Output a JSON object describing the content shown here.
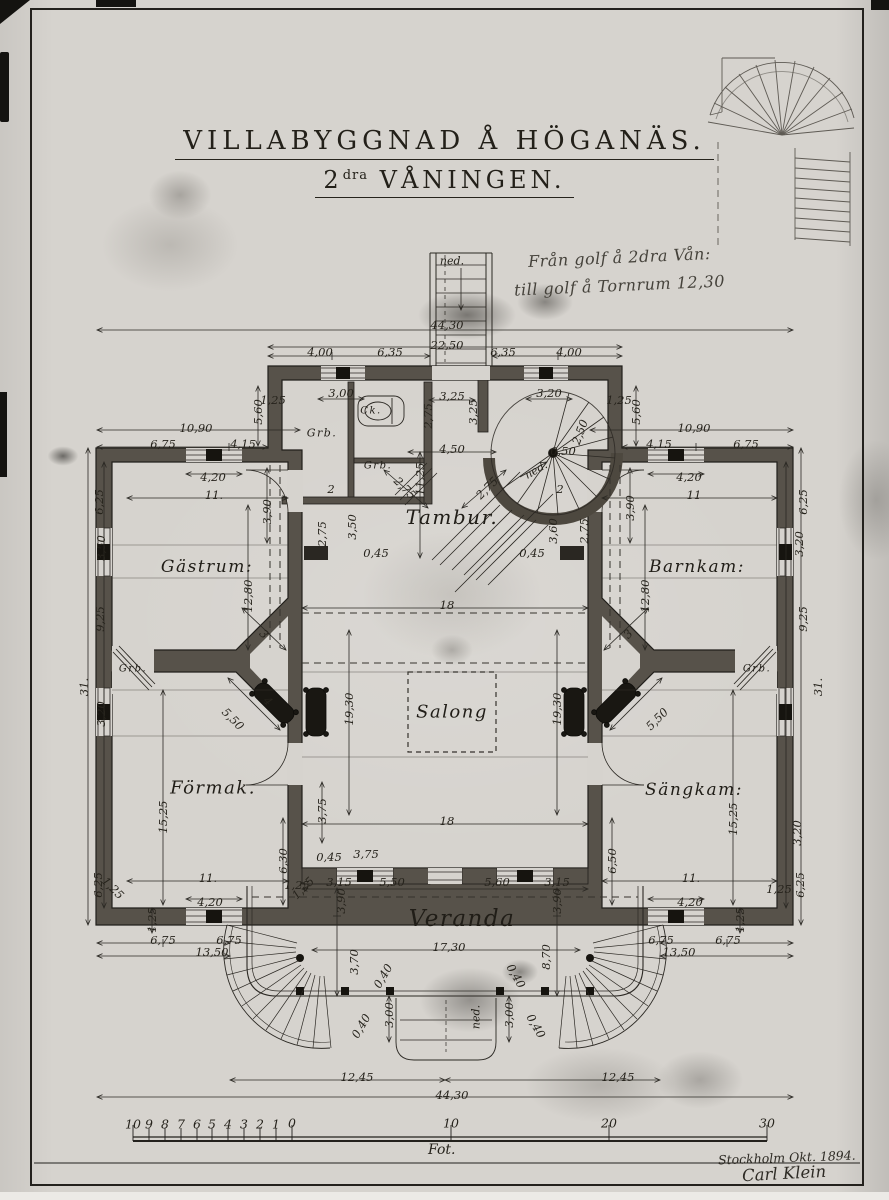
{
  "title": {
    "line1": "VILLABYGGNAD Å HÖGANÄS.",
    "line2_num": "2",
    "line2_sup": "dra",
    "line2_rest": " VÅNINGEN."
  },
  "note": {
    "line1": "Från golf å 2dra Vån:",
    "line2": "till golf å Tornrum 12,30"
  },
  "signature": {
    "line1": "Stockholm Okt. 1894.",
    "line2": "Carl Klein"
  },
  "scale": {
    "unit": "Fot.",
    "numbers": [
      {
        "t": "10",
        "x": 133,
        "y": 1124
      },
      {
        "t": "9",
        "x": 149,
        "y": 1124
      },
      {
        "t": "8",
        "x": 165,
        "y": 1124
      },
      {
        "t": "7",
        "x": 181,
        "y": 1124
      },
      {
        "t": "6",
        "x": 197,
        "y": 1124
      },
      {
        "t": "5",
        "x": 212,
        "y": 1124
      },
      {
        "t": "4",
        "x": 228,
        "y": 1124
      },
      {
        "t": "3",
        "x": 244,
        "y": 1124
      },
      {
        "t": "2",
        "x": 260,
        "y": 1124
      },
      {
        "t": "1",
        "x": 276,
        "y": 1124
      },
      {
        "t": "0",
        "x": 292,
        "y": 1123
      },
      {
        "t": "10",
        "x": 451,
        "y": 1123
      },
      {
        "t": "20",
        "x": 609,
        "y": 1123
      },
      {
        "t": "30",
        "x": 767,
        "y": 1123
      }
    ]
  },
  "plan": {
    "rooms": [
      {
        "t": "Tambur.",
        "x": 452,
        "y": 517,
        "s": 20
      },
      {
        "t": "Gästrum:",
        "x": 207,
        "y": 567,
        "s": 17
      },
      {
        "t": "Barnkam:",
        "x": 697,
        "y": 567,
        "s": 17
      },
      {
        "t": "Salong",
        "x": 452,
        "y": 712,
        "s": 18
      },
      {
        "t": "Förmak.",
        "x": 213,
        "y": 788,
        "s": 18
      },
      {
        "t": "Sängkam:",
        "x": 694,
        "y": 790,
        "s": 17
      },
      {
        "t": "Veranda",
        "x": 462,
        "y": 919,
        "s": 23
      },
      {
        "t": "Grb.",
        "x": 322,
        "y": 433,
        "s": 11
      },
      {
        "t": "Ck.",
        "x": 371,
        "y": 411,
        "s": 10
      },
      {
        "t": "Grb.",
        "x": 378,
        "y": 466,
        "s": 10
      },
      {
        "t": "Grb.",
        "x": 133,
        "y": 669,
        "s": 10
      },
      {
        "t": "Grb.",
        "x": 757,
        "y": 669,
        "s": 10
      }
    ],
    "annotations": [
      {
        "t": "ned.",
        "x": 452,
        "y": 261
      },
      {
        "t": "ned.",
        "x": 536,
        "y": 470,
        "r": -30
      },
      {
        "t": "ned.",
        "x": 476,
        "y": 1017,
        "r": -90
      }
    ],
    "dims": [
      {
        "t": "44,30",
        "x": 447,
        "y": 325
      },
      {
        "t": "22,50",
        "x": 447,
        "y": 345
      },
      {
        "t": "4,00",
        "x": 320,
        "y": 352
      },
      {
        "t": "6,35",
        "x": 390,
        "y": 352
      },
      {
        "t": "6,35",
        "x": 503,
        "y": 352
      },
      {
        "t": "4,00",
        "x": 569,
        "y": 352
      },
      {
        "t": "3,00",
        "x": 341,
        "y": 393
      },
      {
        "t": "3,25",
        "x": 452,
        "y": 396
      },
      {
        "t": "3,20",
        "x": 549,
        "y": 393
      },
      {
        "t": "1,25",
        "x": 619,
        "y": 400
      },
      {
        "t": "1,25",
        "x": 273,
        "y": 400
      },
      {
        "t": "5,60",
        "x": 636,
        "y": 412,
        "r": -90
      },
      {
        "t": "5,60",
        "x": 258,
        "y": 412,
        "r": -90
      },
      {
        "t": "10,90",
        "x": 196,
        "y": 428
      },
      {
        "t": "10,90",
        "x": 694,
        "y": 428
      },
      {
        "t": "6,75",
        "x": 163,
        "y": 444
      },
      {
        "t": "4,15",
        "x": 243,
        "y": 444
      },
      {
        "t": "4,15",
        "x": 659,
        "y": 444
      },
      {
        "t": "6,75",
        "x": 746,
        "y": 444
      },
      {
        "t": "4,20",
        "x": 213,
        "y": 477
      },
      {
        "t": "4,20",
        "x": 689,
        "y": 477
      },
      {
        "t": "11.",
        "x": 214,
        "y": 495
      },
      {
        "t": "11",
        "x": 694,
        "y": 495
      },
      {
        "t": "3,90",
        "x": 267,
        "y": 512,
        "r": -90
      },
      {
        "t": "3,90",
        "x": 630,
        "y": 508,
        "r": -90
      },
      {
        "t": "2,75",
        "x": 428,
        "y": 416,
        "r": -90
      },
      {
        "t": "4,50",
        "x": 452,
        "y": 449
      },
      {
        "t": "11,25",
        "x": 420,
        "y": 479,
        "r": -90
      },
      {
        "t": "0,50",
        "x": 563,
        "y": 451
      },
      {
        "t": "2,50",
        "x": 580,
        "y": 432,
        "r": -70
      },
      {
        "t": "2,75",
        "x": 405,
        "y": 488,
        "r": 45
      },
      {
        "t": "2,75",
        "x": 487,
        "y": 488,
        "r": -45
      },
      {
        "t": "2",
        "x": 331,
        "y": 489
      },
      {
        "t": "2",
        "x": 560,
        "y": 489
      },
      {
        "t": "3,60",
        "x": 553,
        "y": 531,
        "r": -90
      },
      {
        "t": "2,75",
        "x": 584,
        "y": 531,
        "r": -90
      },
      {
        "t": "0,45",
        "x": 376,
        "y": 553
      },
      {
        "t": "0,45",
        "x": 532,
        "y": 553
      },
      {
        "t": "3,50",
        "x": 352,
        "y": 527,
        "r": -90
      },
      {
        "t": "2,75",
        "x": 322,
        "y": 534,
        "r": -90
      },
      {
        "t": "3,25",
        "x": 473,
        "y": 412,
        "r": -90
      },
      {
        "t": "6,25",
        "x": 99,
        "y": 502,
        "r": -90
      },
      {
        "t": "6,25",
        "x": 803,
        "y": 502,
        "r": -90
      },
      {
        "t": "3,50",
        "x": 101,
        "y": 548,
        "r": -90
      },
      {
        "t": "3,20",
        "x": 799,
        "y": 544,
        "r": -90
      },
      {
        "t": "9,25",
        "x": 100,
        "y": 619,
        "r": -90
      },
      {
        "t": "9,25",
        "x": 803,
        "y": 619,
        "r": -90
      },
      {
        "t": "31.",
        "x": 84,
        "y": 687,
        "r": -90
      },
      {
        "t": "31.",
        "x": 818,
        "y": 687,
        "r": -90
      },
      {
        "t": "3,20",
        "x": 101,
        "y": 714,
        "r": -90
      },
      {
        "t": "12,80",
        "x": 248,
        "y": 596,
        "r": -90
      },
      {
        "t": "12,80",
        "x": 645,
        "y": 596,
        "r": -90
      },
      {
        "t": "18",
        "x": 447,
        "y": 605
      },
      {
        "t": "18",
        "x": 447,
        "y": 821
      },
      {
        "t": "19,30",
        "x": 349,
        "y": 709,
        "r": -90
      },
      {
        "t": "19,30",
        "x": 557,
        "y": 709,
        "r": -90
      },
      {
        "t": "3",
        "x": 264,
        "y": 634,
        "r": 45
      },
      {
        "t": "3",
        "x": 628,
        "y": 634,
        "r": -45
      },
      {
        "t": "4",
        "x": 268,
        "y": 701,
        "r": 45
      },
      {
        "t": "5,50",
        "x": 233,
        "y": 719,
        "r": 45
      },
      {
        "t": "5,50",
        "x": 657,
        "y": 719,
        "r": -45
      },
      {
        "t": "15,25",
        "x": 163,
        "y": 817,
        "r": -90
      },
      {
        "t": "15,25",
        "x": 733,
        "y": 819,
        "r": -90
      },
      {
        "t": "6,30",
        "x": 283,
        "y": 861,
        "r": -90
      },
      {
        "t": "6,50",
        "x": 612,
        "y": 861,
        "r": -90
      },
      {
        "t": "3,75",
        "x": 322,
        "y": 811,
        "r": -90
      },
      {
        "t": "3,75",
        "x": 366,
        "y": 854
      },
      {
        "t": "0,45",
        "x": 329,
        "y": 857
      },
      {
        "t": "3,15",
        "x": 339,
        "y": 882
      },
      {
        "t": "5,50",
        "x": 392,
        "y": 882
      },
      {
        "t": "5,60",
        "x": 497,
        "y": 882
      },
      {
        "t": "3,15",
        "x": 557,
        "y": 882
      },
      {
        "t": "3,90",
        "x": 341,
        "y": 901,
        "r": -90
      },
      {
        "t": "3,90",
        "x": 557,
        "y": 901,
        "r": -90
      },
      {
        "t": "1,25",
        "x": 297,
        "y": 885
      },
      {
        "t": "11.",
        "x": 208,
        "y": 878
      },
      {
        "t": "11.",
        "x": 691,
        "y": 878
      },
      {
        "t": "4,20",
        "x": 210,
        "y": 902
      },
      {
        "t": "4,20",
        "x": 690,
        "y": 902
      },
      {
        "t": "3,20",
        "x": 797,
        "y": 833,
        "r": -90
      },
      {
        "t": "6,25",
        "x": 800,
        "y": 885,
        "r": -90
      },
      {
        "t": "6,25",
        "x": 98,
        "y": 885,
        "r": -90
      },
      {
        "t": "1,25",
        "x": 779,
        "y": 889
      },
      {
        "t": "17,30",
        "x": 449,
        "y": 947
      },
      {
        "t": "3,70",
        "x": 354,
        "y": 962,
        "r": -90
      },
      {
        "t": "8,70",
        "x": 546,
        "y": 957,
        "r": -90
      },
      {
        "t": "0,40",
        "x": 383,
        "y": 976,
        "r": -60
      },
      {
        "t": "0,40",
        "x": 516,
        "y": 976,
        "r": 60
      },
      {
        "t": "0,40",
        "x": 361,
        "y": 1026,
        "r": -60
      },
      {
        "t": "0,40",
        "x": 536,
        "y": 1026,
        "r": 60
      },
      {
        "t": "3,00",
        "x": 389,
        "y": 1015,
        "r": -90
      },
      {
        "t": "3,00",
        "x": 509,
        "y": 1015,
        "r": -90
      },
      {
        "t": "12,45",
        "x": 357,
        "y": 1077
      },
      {
        "t": "12,45",
        "x": 618,
        "y": 1077
      },
      {
        "t": "44,30",
        "x": 452,
        "y": 1095
      },
      {
        "t": "6,75",
        "x": 163,
        "y": 940
      },
      {
        "t": "6,75",
        "x": 229,
        "y": 940
      },
      {
        "t": "13,50",
        "x": 212,
        "y": 952
      },
      {
        "t": "6,75",
        "x": 661,
        "y": 940
      },
      {
        "t": "6,75",
        "x": 728,
        "y": 940
      },
      {
        "t": "13,50",
        "x": 679,
        "y": 952
      },
      {
        "t": "1,25",
        "x": 152,
        "y": 920,
        "r": -90
      },
      {
        "t": "1,25",
        "x": 740,
        "y": 920,
        "r": -90
      },
      {
        "t": "1,25",
        "x": 113,
        "y": 888,
        "r": 45
      },
      {
        "t": "1,25",
        "x": 303,
        "y": 888,
        "r": -45
      }
    ]
  },
  "colors": {
    "ink": "#2b2823",
    "paper": "#d6d3ce",
    "wall_poche": "#57524a"
  }
}
